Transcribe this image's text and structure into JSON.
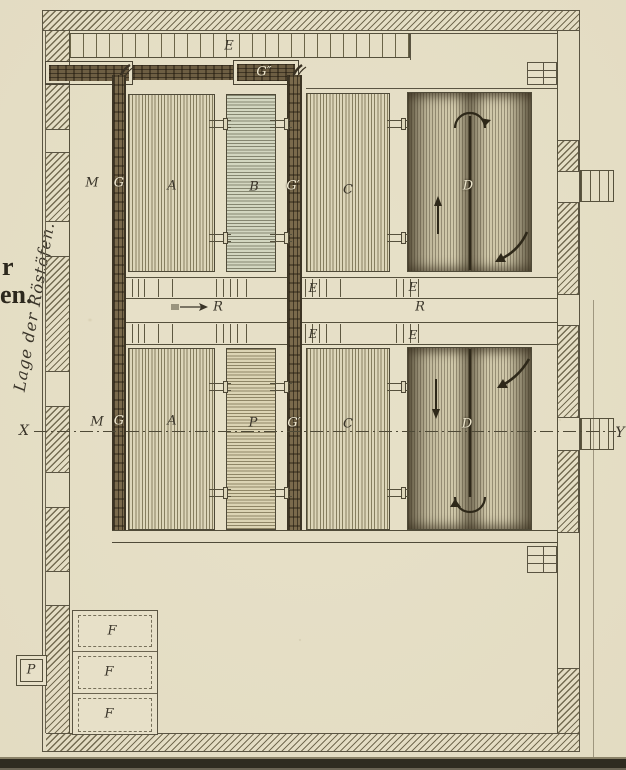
{
  "margin": {
    "rotated_title": "Lage der Röstöfen.",
    "cut_line1": "r",
    "cut_line2": "en."
  },
  "labels": {
    "grate_top_e": "E",
    "flue_top_g": "G″",
    "upper_m": "M",
    "upper_g": "G",
    "upper_a": "A",
    "upper_b": "B",
    "upper_g2": "G′",
    "upper_c": "C",
    "upper_d": "D",
    "mid_e_left_top": "E",
    "mid_e_right_top": "E",
    "mid_r_left": "R",
    "mid_r_right": "R",
    "mid_e_left_bot": "E",
    "mid_e_right_bot": "E",
    "axis_x": "X",
    "axis_y": "Y",
    "lower_m": "M",
    "lower_g": "G",
    "lower_a": "A",
    "lower_p": "P",
    "lower_g2": "G′",
    "lower_c": "C",
    "lower_d": "D",
    "ash_f1": "F",
    "ash_f2": "F",
    "ash_f3": "F",
    "outside_p_box": "P"
  },
  "colors": {
    "paper": "#e8e1c9",
    "ink": "#4e4936",
    "wood_flue": "#6d5e43"
  }
}
